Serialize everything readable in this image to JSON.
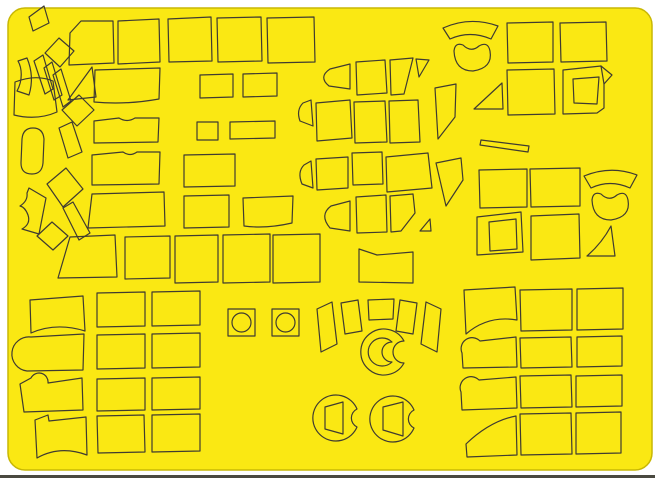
{
  "image": {
    "description": "Yellow kabuki-tape die-cut masking sheet with outlined paint-mask shapes (canopy frames, wheels, panels)",
    "background_color": "#FFFFFF",
    "bottom_edge_color": "#4A4940"
  },
  "sheet": {
    "fill": "#FAE813",
    "edge_stroke": "#C8B704",
    "outline_color": "#3F3B31",
    "outline_width": 1.2,
    "x": 8,
    "y": 8,
    "width": 644,
    "height": 462,
    "corner_radius": 17,
    "shapes": [
      {
        "name": "tl-tilted-quad",
        "d": "M 29,17 L 44,6 L 49,23 L 33,31 Z"
      },
      {
        "name": "tl-tilted-square",
        "d": "M 45,53 L 59,38 L 74,51 L 60,67 Z"
      },
      {
        "name": "tl-strip-1",
        "d": "M 34,61 L 43,55 L 53,89 L 45,94 Z"
      },
      {
        "name": "tl-strip-2",
        "d": "M 44,68 L 52,62 L 62,95 L 54,100 Z"
      },
      {
        "name": "tl-strip-3",
        "d": "M 53,75 L 61,69 L 71,101 L 63,107 Z"
      },
      {
        "name": "tl-arc-wedge",
        "d": "M 27,58 C 32,70 33,82 29,95 L 17,91 C 23,80 22,68 18,61 Z"
      },
      {
        "name": "tl-curved-panel",
        "d": "M 15,82 C 28,77 41,76 53,81 L 57,112 C 41,119 26,118 14,115 Z"
      },
      {
        "name": "tl-triangle",
        "d": "M 68,100 L 92,67 L 96,97 Z"
      },
      {
        "name": "tl-diamond",
        "d": "M 62,110 L 79,95 L 94,110 L 77,126 Z"
      },
      {
        "name": "tl-strip-4",
        "d": "M 59,128 L 72,122 L 82,152 L 68,158 Z"
      },
      {
        "name": "left-capsule",
        "d": "M 22,139 Q 23,128 33,128 Q 43,128 44,139 L 43,163 Q 42,174 32,174 Q 21,174 21,163 Z"
      },
      {
        "name": "left-tilted-square",
        "d": "M 47,184 L 66,168 L 83,189 L 63,207 Z"
      },
      {
        "name": "left-notched-blob",
        "d": "M 29,188 L 46,198 L 39,234 L 22,229 Q 31,224 28,215 Q 25,207 20,206 Q 28,201 27,193 Z"
      },
      {
        "name": "left-strip",
        "d": "M 63,208 L 73,202 L 90,233 L 79,240 Z"
      },
      {
        "name": "left-small-diamond",
        "d": "M 37,236 L 52,222 L 68,236 L 53,250 Z"
      },
      {
        "name": "panel-r1-1",
        "d": "M 70,33 L 81,21 L 113,21 L 114,63 L 69,65 Z"
      },
      {
        "name": "panel-r1-2",
        "d": "M 118,21 L 159,19 L 160,62 L 118,64 Z"
      },
      {
        "name": "panel-r1-3",
        "d": "M 168,19 L 211,17 L 212,61 L 169,62 Z"
      },
      {
        "name": "panel-r1-4",
        "d": "M 217,18 L 261,17 L 262,61 L 218,62 Z"
      },
      {
        "name": "panel-r1-5",
        "d": "M 267,18 L 314,17 L 315,62 L 268,63 Z"
      },
      {
        "name": "panel-r2-1",
        "d": "M 95,70 L 160,68 L 159,99 Q 126,105 94,102 Z"
      },
      {
        "name": "panel-r2-2",
        "d": "M 200,75 L 233,74 L 233,97 L 200,98 Z"
      },
      {
        "name": "panel-r2-3",
        "d": "M 243,74 L 277,73 L 277,96 L 243,97 Z"
      },
      {
        "name": "panel-r3-1",
        "d": "M 94,121 L 119,118 Q 127,123 135,118 L 159,118 L 158,142 L 94,143 Z"
      },
      {
        "name": "panel-r3-2",
        "d": "M 197,122 L 218,122 L 218,140 L 197,140 Z"
      },
      {
        "name": "panel-r3-3",
        "d": "M 230,122 L 275,121 L 275,138 L 230,139 Z"
      },
      {
        "name": "panel-r4-1",
        "d": "M 92,155 L 123,152 Q 130,157 137,152 L 160,152 L 159,184 L 92,185 Z"
      },
      {
        "name": "panel-r4-2",
        "d": "M 184,155 L 235,154 L 235,186 L 184,187 Z"
      },
      {
        "name": "panel-r5-1",
        "d": "M 92,194 L 164,192 L 165,226 L 88,228 Z"
      },
      {
        "name": "panel-r5-2",
        "d": "M 184,196 L 229,195 L 229,227 L 184,228 Z"
      },
      {
        "name": "panel-r5-3",
        "d": "M 243,198 L 293,196 L 292,223 Q 266,229 244,226 Z"
      },
      {
        "name": "panel-r6-1",
        "d": "M 70,237 L 115,235 L 117,277 L 58,278 Z"
      },
      {
        "name": "panel-r6-2",
        "d": "M 125,237 L 170,236 L 170,278 L 125,279 Z"
      },
      {
        "name": "panel-r6-3",
        "d": "M 175,236 L 218,235 L 218,282 L 175,283 Z"
      },
      {
        "name": "panel-r6-4",
        "d": "M 223,235 L 270,234 L 270,282 L 223,283 Z"
      },
      {
        "name": "panel-r6-5",
        "d": "M 273,235 L 320,234 L 320,282 L 273,283 Z"
      },
      {
        "name": "canopy-a1",
        "d": "M 350,64 L 350,89 L 329,86 Q 318,77 330,69 Z"
      },
      {
        "name": "canopy-a2",
        "d": "M 356,62 L 385,60 L 387,93 L 357,95 Z"
      },
      {
        "name": "canopy-a3",
        "d": "M 390,60 L 413,58 L 404,94 L 391,95 Z"
      },
      {
        "name": "canopy-a4",
        "d": "M 416,59 L 429,60 L 419,77 Z"
      },
      {
        "name": "canopy-b1",
        "d": "M 311,100 L 313,126 L 300,121 Q 296,110 303,103 Z"
      },
      {
        "name": "canopy-b2",
        "d": "M 316,103 L 350,100 L 352,138 L 317,141 Z"
      },
      {
        "name": "canopy-b3",
        "d": "M 354,102 L 385,101 L 387,142 L 355,143 Z"
      },
      {
        "name": "canopy-b4",
        "d": "M 389,101 L 418,100 L 420,142 L 390,143 Z"
      },
      {
        "name": "canopy-b5",
        "d": "M 435,88 L 456,84 L 455,117 L 438,139 Z"
      },
      {
        "name": "canopy-c1",
        "d": "M 311,161 L 313,188 L 302,184 Q 297,172 304,165 Z"
      },
      {
        "name": "canopy-c2",
        "d": "M 316,159 L 348,157 L 348,188 L 317,190 Z"
      },
      {
        "name": "canopy-c3",
        "d": "M 352,153 L 382,152 L 383,184 L 353,185 Z"
      },
      {
        "name": "canopy-c4",
        "d": "M 386,157 L 428,153 L 432,188 L 387,192 Z"
      },
      {
        "name": "canopy-c5",
        "d": "M 436,163 L 461,158 L 463,180 L 446,206 Z"
      },
      {
        "name": "canopy-d1",
        "d": "M 350,201 L 350,231 L 330,228 Q 319,215 331,206 Z"
      },
      {
        "name": "canopy-d2",
        "d": "M 356,197 L 386,195 L 387,232 L 357,233 Z"
      },
      {
        "name": "canopy-d3",
        "d": "M 390,196 L 413,194 L 415,213 L 401,231 L 391,232 Z"
      },
      {
        "name": "canopy-d4",
        "d": "M 420,231 L 430,219 L 431,231 Z"
      },
      {
        "name": "stepped-panel",
        "d": "M 359,249 L 377,255 L 413,252 L 413,283 L 359,282 Z"
      },
      {
        "name": "eyebrow-top",
        "d": "M 443,28 Q 470,16 498,26 L 491,39 Q 470,30 450,39 Z"
      },
      {
        "name": "kidney-top",
        "d": "M 454,51 Q 455,42 463,45 Q 471,53 479,46 Q 488,41 490,51 Q 493,68 473,71 Q 455,71 454,51 Z"
      },
      {
        "name": "tr-panel-1",
        "d": "M 507,23 L 553,22 L 553,62 L 508,63 Z"
      },
      {
        "name": "tr-panel-2",
        "d": "M 560,23 L 606,22 L 607,61 L 561,62 Z"
      },
      {
        "name": "tr-panel-3",
        "d": "M 507,70 L 554,69 L 555,114 L 508,115 Z"
      },
      {
        "name": "tr-frame-outer",
        "d": "M 563,70 L 601,66 L 612,75 L 604,84 L 604,108 L 597,113 L 563,114 Z"
      },
      {
        "name": "tr-frame-crease",
        "d": "M 601,66 L 604,84"
      },
      {
        "name": "tr-frame-inner",
        "d": "M 573,79 L 599,77 L 597,104 L 574,103 Z"
      },
      {
        "name": "tr-triangle",
        "d": "M 502,83 Q 487,97 474,109 L 503,109 Z"
      },
      {
        "name": "tr-sliver",
        "d": "M 481,140 L 529,146 L 528,152 L 480,145 Z"
      },
      {
        "name": "mr-panel-1",
        "d": "M 479,170 L 527,169 L 527,207 L 480,208 Z"
      },
      {
        "name": "mr-panel-2",
        "d": "M 530,169 L 580,168 L 580,206 L 531,207 Z"
      },
      {
        "name": "mr-frame-outer",
        "d": "M 477,217 L 521,212 L 523,252 L 477,255 Z"
      },
      {
        "name": "mr-frame-inner",
        "d": "M 489,222 L 516,219 L 517,249 L 490,251 Z"
      },
      {
        "name": "mr-panel-3",
        "d": "M 531,216 L 579,214 L 580,258 L 531,260 Z"
      },
      {
        "name": "eyebrow-mid",
        "d": "M 584,176 Q 611,165 637,175 L 630,188 Q 610,179 591,188 Z"
      },
      {
        "name": "kidney-mid",
        "d": "M 592,200 Q 593,191 601,194 Q 609,202 617,195 Q 626,190 628,200 Q 631,217 611,220 Q 593,220 592,200 Z"
      },
      {
        "name": "mr-concave-wedge",
        "d": "M 611,226 L 615,256 L 587,256 Q 602,243 611,226 Z"
      },
      {
        "name": "wheel-box-1",
        "d": "M 228,309 L 255,309 L 255,336 L 228,336 Z"
      },
      {
        "name": "wheel-box-1-circle",
        "d": "M 232,322.5 a 9.5,9.5 0 1 0 19,0 a 9.5,9.5 0 1 0 -19,0 Z"
      },
      {
        "name": "wheel-box-2",
        "d": "M 272,309 L 299,309 L 299,336 L 272,336 Z"
      },
      {
        "name": "wheel-box-2-circle",
        "d": "M 276,322.5 a 9.5,9.5 0 1 0 19,0 a 9.5,9.5 0 1 0 -19,0 Z"
      },
      {
        "name": "blade-1",
        "d": "M 317,309 L 332,302 L 337,344 L 321,352 Z"
      },
      {
        "name": "blade-2",
        "d": "M 341,303 L 358,300 L 362,331 L 345,334 Z"
      },
      {
        "name": "blade-3",
        "d": "M 368,300 L 394,299 L 393,319 L 369,320 Z"
      },
      {
        "name": "blade-4",
        "d": "M 400,300 L 417,303 L 413,334 L 396,331 Z"
      },
      {
        "name": "blade-5",
        "d": "M 426,302 L 441,309 L 437,352 L 421,344 Z"
      },
      {
        "name": "hub-disc",
        "d": "M 404,341 A 23,23 0 1 0 404,363 A 11,11 0 0 1 404,341 Z"
      },
      {
        "name": "hub-crescent",
        "d": "M 392,342 A 14,14 0 1 0 392,362 A 9,9 0 0 1 392,342 Z"
      },
      {
        "name": "wheel-disc-1",
        "d": "M 357,409 A 23,23 0 1 0 357,427 A 10,10 0 0 1 357,409 Z"
      },
      {
        "name": "wheel-disc-1-window",
        "d": "M 325,407 L 343,402 L 343,434 L 325,429 Z"
      },
      {
        "name": "wheel-disc-2",
        "d": "M 414,410 A 23,23 0 1 0 414,428 A 10,10 0 0 1 414,410 Z"
      },
      {
        "name": "wheel-disc-2-window",
        "d": "M 383,407 L 403,402 L 403,436 L 383,430 Z"
      },
      {
        "name": "bl-wing-1",
        "d": "M 30,300 L 83,296 L 85,331 Q 56,322 31,333 Z"
      },
      {
        "name": "bl-notch-1",
        "d": "M 31,337 L 84,334 L 83,370 L 27,371 A 17,17 0 0 1 31,337 Z"
      },
      {
        "name": "bl-notch-2",
        "d": "M 20,384 L 31,378 A 9,9 0 0 1 48,383 L 82,378 L 83,410 L 24,412 Z"
      },
      {
        "name": "bl-wing-2",
        "d": "M 35,420 L 48,415 L 49,421 L 86,417 L 87,455 Q 60,445 37,458 Z"
      },
      {
        "name": "bl-grid-r1c1",
        "d": "M 97,293 L 145,292 L 145,326 L 97,327 Z"
      },
      {
        "name": "bl-grid-r1c2",
        "d": "M 152,292 L 200,291 L 200,325 L 152,326 Z"
      },
      {
        "name": "bl-grid-r2c1",
        "d": "M 97,335 L 145,334 L 145,368 L 97,369 Z"
      },
      {
        "name": "bl-grid-r2c2",
        "d": "M 152,334 L 200,333 L 200,367 L 152,368 Z"
      },
      {
        "name": "bl-grid-r3c1",
        "d": "M 97,379 L 145,378 L 145,410 L 97,411 Z"
      },
      {
        "name": "bl-grid-r3c2",
        "d": "M 152,378 L 200,377 L 200,409 L 152,410 Z"
      },
      {
        "name": "bl-grid-r4c1",
        "d": "M 97,416 L 144,415 L 145,452 L 98,453 Z"
      },
      {
        "name": "bl-grid-r4c2",
        "d": "M 152,415 L 200,414 L 200,451 L 152,452 Z"
      },
      {
        "name": "br-wing-1",
        "d": "M 464,290 L 515,287 L 517,320 Q 488,315 466,334 Z"
      },
      {
        "name": "br-notch-1",
        "d": "M 462,353 A 11,11 0 0 1 480,341 L 516,337 L 517,367 L 463,368 Z"
      },
      {
        "name": "br-notch-2",
        "d": "M 461,392 A 11,11 0 0 1 479,380 L 516,377 L 517,408 L 462,410 Z"
      },
      {
        "name": "br-wing-2",
        "d": "M 466,444 Q 490,421 516,416 L 517,455 L 467,457 Z"
      },
      {
        "name": "br-grid-r1c1",
        "d": "M 520,290 L 572,289 L 572,330 L 521,331 Z"
      },
      {
        "name": "br-grid-r1c2",
        "d": "M 577,289 L 623,288 L 623,329 L 577,330 Z"
      },
      {
        "name": "br-grid-r2c1",
        "d": "M 520,338 L 571,337 L 572,367 L 521,368 Z"
      },
      {
        "name": "br-grid-r2c2",
        "d": "M 577,337 L 622,336 L 622,366 L 577,367 Z"
      },
      {
        "name": "br-grid-r3c1",
        "d": "M 520,376 L 571,375 L 572,407 L 521,408 Z"
      },
      {
        "name": "br-grid-r3c2",
        "d": "M 576,376 L 622,375 L 622,406 L 576,407 Z"
      },
      {
        "name": "br-grid-r4c1",
        "d": "M 520,414 L 571,413 L 572,454 L 521,455 Z"
      },
      {
        "name": "br-grid-r4c2",
        "d": "M 576,413 L 621,412 L 621,453 L 576,454 Z"
      }
    ]
  }
}
